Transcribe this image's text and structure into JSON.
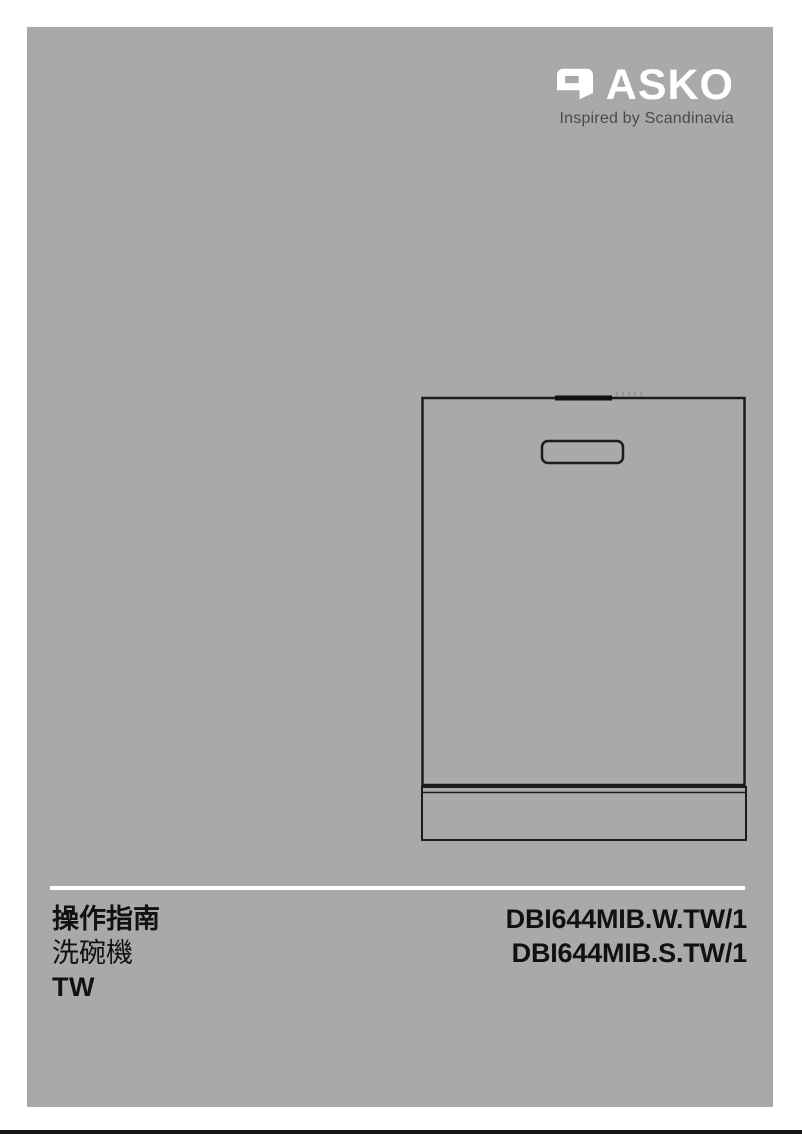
{
  "page": {
    "background_color": "#ffffff",
    "panel_color": "#a9a9a9",
    "edge_bar_color": "#15171b"
  },
  "logo": {
    "brand": "ASKO",
    "tagline": "Inspired by Scandinavia",
    "brand_color": "#ffffff",
    "tagline_color": "#4a4a4a",
    "mark_icon": "asko-a-logomark"
  },
  "illustration": {
    "name": "built-in-dishwasher-front-line-drawing",
    "line_color": "#1c1c1c",
    "parts": [
      "door",
      "top-control-panel-strip",
      "handle-recess",
      "plinth-kick-panel"
    ]
  },
  "footer": {
    "divider_color": "#ffffff",
    "title": "操作指南",
    "product": "洗碗機",
    "language": "TW",
    "models": [
      "DBI644MIB.W.TW/1",
      "DBI644MIB.S.TW/1"
    ],
    "text_color": "#111111"
  }
}
